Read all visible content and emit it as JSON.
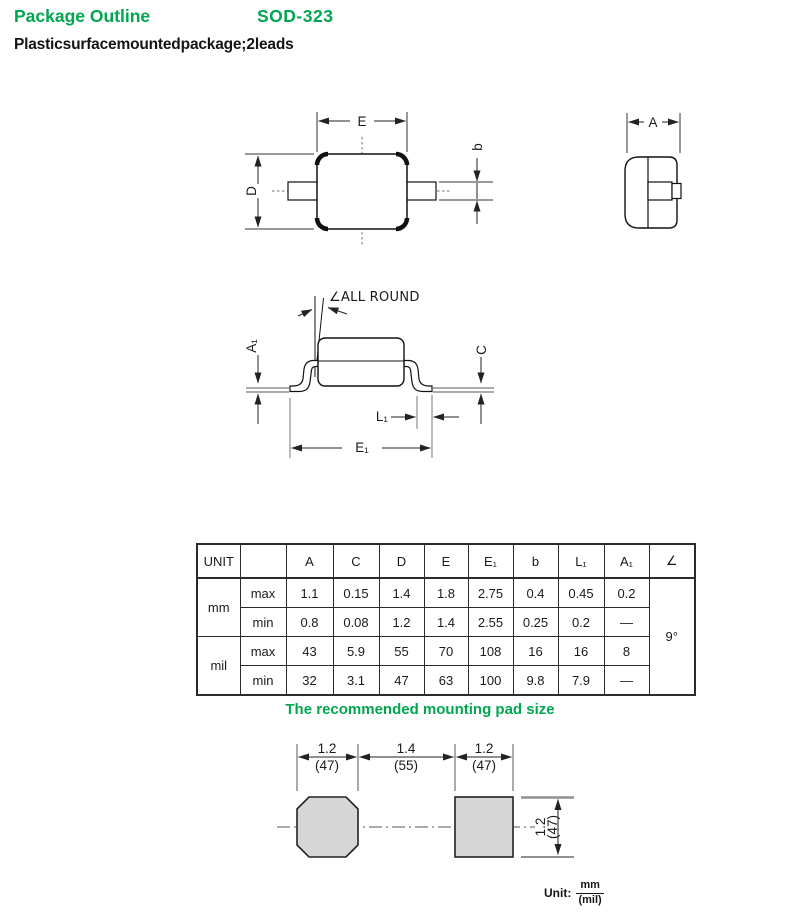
{
  "header": {
    "title": "Package Outline",
    "part_number": "SOD-323",
    "subtitle": "Plastic surface mounted package; 2 leads"
  },
  "drawings": {
    "top_view": {
      "dim_E": "E",
      "dim_D": "D",
      "dim_b": "b"
    },
    "end_view": {
      "dim_A": "A"
    },
    "side_view": {
      "angle_note": "∠ALL ROUND",
      "dim_A1": "A₁",
      "dim_C": "C",
      "dim_L1": "L₁",
      "dim_E1": "E₁"
    }
  },
  "table": {
    "headers": [
      "UNIT",
      "",
      "A",
      "C",
      "D",
      "E",
      "E₁",
      "b",
      "L₁",
      "A₁",
      "∠"
    ],
    "row_groups": [
      {
        "unit": "mm",
        "rows": [
          {
            "limit": "max",
            "values": [
              "1.1",
              "0.15",
              "1.4",
              "1.8",
              "2.75",
              "0.4",
              "0.45",
              "0.2"
            ]
          },
          {
            "limit": "min",
            "values": [
              "0.8",
              "0.08",
              "1.2",
              "1.4",
              "2.55",
              "0.25",
              "0.2",
              "—"
            ]
          }
        ]
      },
      {
        "unit": "mil",
        "rows": [
          {
            "limit": "max",
            "values": [
              "43",
              "5.9",
              "55",
              "70",
              "108",
              "16",
              "16",
              "8"
            ]
          },
          {
            "limit": "min",
            "values": [
              "32",
              "3.1",
              "47",
              "63",
              "100",
              "9.8",
              "7.9",
              "—"
            ]
          }
        ]
      }
    ],
    "angle_value": "9°"
  },
  "pad": {
    "title": "The recommended mounting pad size",
    "top_dims": [
      {
        "mm": "1.2",
        "mil": "(47)"
      },
      {
        "mm": "1.4",
        "mil": "(55)"
      },
      {
        "mm": "1.2",
        "mil": "(47)"
      }
    ],
    "side_dim": {
      "mm": "1.2",
      "mil": "(47)"
    },
    "unit": {
      "label": "Unit:",
      "numerator": "mm",
      "denominator": "(mil)"
    }
  }
}
